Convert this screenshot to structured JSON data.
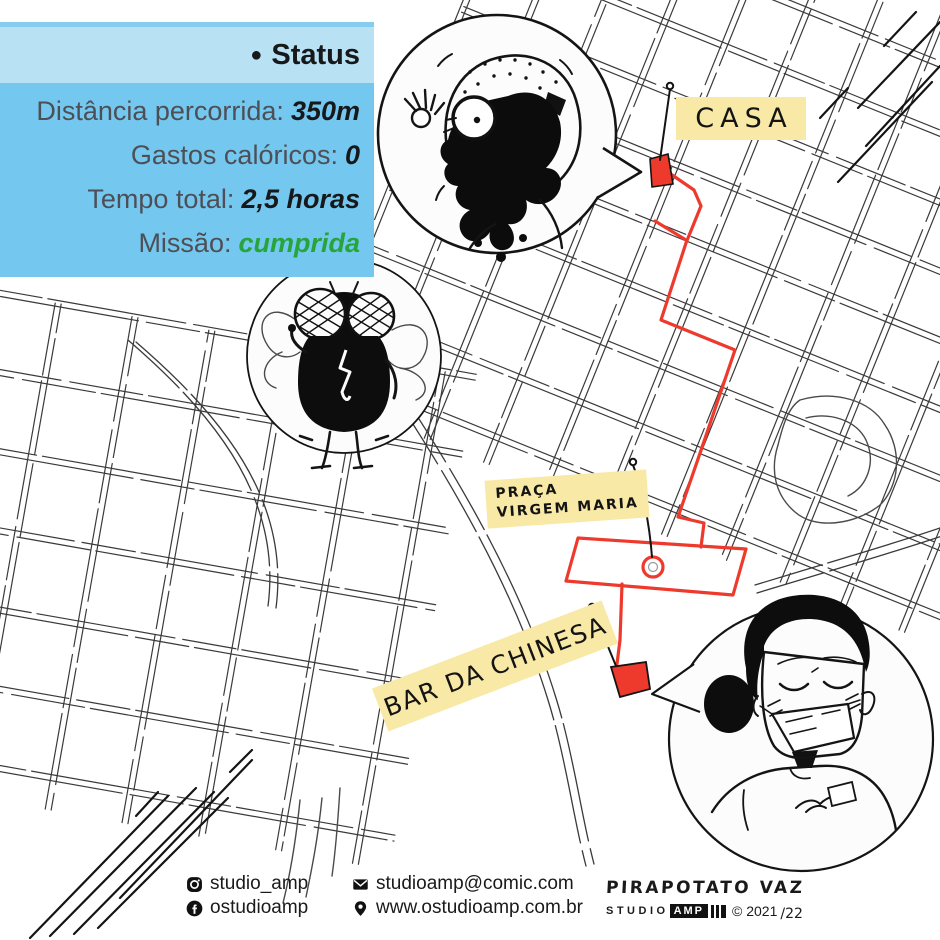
{
  "status": {
    "bullet": "●",
    "title": "Status",
    "rows": [
      {
        "label": "Distância percorrida:",
        "value": "350m"
      },
      {
        "label": "Gastos calóricos:",
        "value": "0"
      },
      {
        "label": "Tempo total:",
        "value": "2,5 horas"
      },
      {
        "label": "Missão:",
        "value": "cumprida"
      }
    ]
  },
  "map": {
    "labels": {
      "casa": "CASA",
      "praca_line1": "PRAÇA",
      "praca_line2": "VIRGEM MARIA",
      "bar": "BAR DA CHINESA"
    },
    "illustrations": [
      {
        "icon": "oil-covered-man-illustration"
      },
      {
        "icon": "fly-illustration"
      },
      {
        "icon": "masked-woman-illustration"
      }
    ],
    "icons": [
      "map-pin-dot-icon",
      "roundabout-icon"
    ]
  },
  "footer": {
    "instagram_handle": "studio_amp",
    "facebook_handle": "ostudioamp",
    "email": "studioamp@comic.com",
    "website": "www.ostudioamp.com.br",
    "author": "PIRAPOTATO VAZ",
    "studio_word": "STUDIO",
    "studio_box": "AMP",
    "copyright": "© 2021",
    "year_suffix": "/22",
    "icons": [
      "instagram-icon",
      "facebook-icon",
      "envelope-icon",
      "location-pin-icon"
    ]
  },
  "colors": {
    "route_red": "#ee392d",
    "label_yellow": "#f8e9a6",
    "panel_header_blue": "#b9e1f4",
    "panel_body_blue": "#74c7ee",
    "mission_green": "#27a43a",
    "ink_black": "#141414"
  }
}
